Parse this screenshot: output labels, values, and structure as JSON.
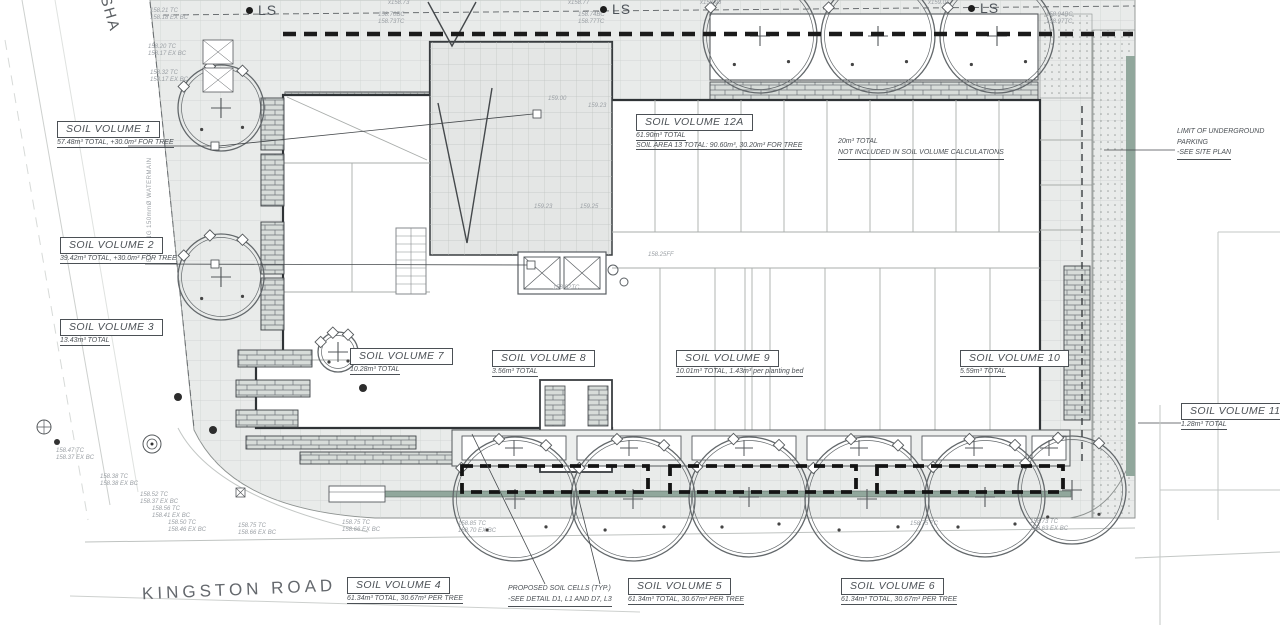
{
  "roads": {
    "kingston": "KINGSTON ROAD",
    "side_street": "SHA",
    "watermain": "EXISTING 150mmØ WATERMAIN"
  },
  "ls_label": "LS",
  "ls_markers": [
    {
      "x": 246,
      "y": 2
    },
    {
      "x": 600,
      "y": 1
    },
    {
      "x": 968,
      "y": 0
    }
  ],
  "soil_volumes": [
    {
      "id": "1",
      "x": 57,
      "y": 119,
      "title": "SOIL VOLUME 1",
      "sub": "57.48m³ TOTAL, +30.0m³ FOR TREE"
    },
    {
      "id": "2",
      "x": 60,
      "y": 235,
      "title": "SOIL VOLUME 2",
      "sub": "39.42m³ TOTAL, +30.0m³ FOR TREE"
    },
    {
      "id": "3",
      "x": 60,
      "y": 317,
      "title": "SOIL VOLUME 3",
      "sub": "13.43m³ TOTAL"
    },
    {
      "id": "12a",
      "x": 636,
      "y": 112,
      "title": "SOIL VOLUME 12A",
      "sub": "61.90m³ TOTAL",
      "sub2": "SOIL AREA 13 TOTAL: 90.60m³, 30.20m³ FOR TREE"
    },
    {
      "id": "7",
      "x": 350,
      "y": 346,
      "title": "SOIL VOLUME 7",
      "sub": "10.28m³ TOTAL"
    },
    {
      "id": "8",
      "x": 492,
      "y": 348,
      "title": "SOIL VOLUME 8",
      "sub": "3.56m³ TOTAL"
    },
    {
      "id": "9",
      "x": 676,
      "y": 348,
      "title": "SOIL VOLUME 9",
      "sub": "10.01m³ TOTAL, 1.43m³ per planting bed"
    },
    {
      "id": "10",
      "x": 960,
      "y": 348,
      "title": "SOIL VOLUME 10",
      "sub": "5.59m³ TOTAL"
    },
    {
      "id": "11",
      "x": 1181,
      "y": 401,
      "title": "SOIL VOLUME 11",
      "sub": "1.28m³ TOTAL"
    },
    {
      "id": "4",
      "x": 347,
      "y": 575,
      "title": "SOIL VOLUME 4",
      "sub": "61.34m³ TOTAL, 30.67m³ PER TREE"
    },
    {
      "id": "5",
      "x": 628,
      "y": 576,
      "title": "SOIL VOLUME 5",
      "sub": "61.34m³ TOTAL, 30.67m³ PER TREE"
    },
    {
      "id": "6",
      "x": 841,
      "y": 576,
      "title": "SOIL VOLUME 6",
      "sub": "61.34m³ TOTAL, 30.67m³ PER TREE"
    }
  ],
  "notes": [
    {
      "id": "underground-parking",
      "x": 1177,
      "y": 127,
      "lines": [
        {
          "t": "LIMIT OF UNDERGROUND"
        },
        {
          "t": "PARKING"
        },
        {
          "t": "-SEE SITE PLAN",
          "u": true
        }
      ]
    },
    {
      "id": "not-included",
      "x": 838,
      "y": 137,
      "lines": [
        {
          "t": "20m³ TOTAL"
        },
        {
          "t": "NOT INCLUDED IN SOIL VOLUME CALCULATIONS",
          "u": true
        }
      ]
    },
    {
      "id": "proposed-soil-cells",
      "x": 508,
      "y": 584,
      "lines": [
        {
          "t": "PROPOSED SOIL CELLS (TYP.)"
        },
        {
          "t": "-SEE DETAIL D1, L1 AND D7, L3",
          "u": true
        }
      ]
    }
  ],
  "spot_elevations": [
    {
      "x": 150,
      "y": 8,
      "l1": "158.21 TC",
      "l2": "158.18 EX BC"
    },
    {
      "x": 148,
      "y": 44,
      "l1": "158.20 TC",
      "l2": "158.17 EX BC"
    },
    {
      "x": 150,
      "y": 70,
      "l1": "158.32 TC",
      "l2": "158.17 EX BC"
    },
    {
      "x": 378,
      "y": 12,
      "l1": "158.70BC",
      "l2": "158.73TC"
    },
    {
      "x": 578,
      "y": 12,
      "l1": "158.74BC",
      "l2": "158.77TC"
    },
    {
      "x": 1046,
      "y": 12,
      "l1": "158.94BC",
      "l2": "158.97TC"
    },
    {
      "x": 388,
      "y": 0,
      "l1": "x158.73"
    },
    {
      "x": 568,
      "y": 0,
      "l1": "x158.77"
    },
    {
      "x": 700,
      "y": 0,
      "l1": "x158.96"
    },
    {
      "x": 928,
      "y": 0,
      "l1": "x159.01"
    },
    {
      "x": 56,
      "y": 448,
      "l1": "158.47 TC",
      "l2": "158.37 EX BC"
    },
    {
      "x": 100,
      "y": 474,
      "l1": "158.38 TC",
      "l2": "158.38 EX BC"
    },
    {
      "x": 140,
      "y": 492,
      "l1": "158.52 TC",
      "l2": "158.37 EX BC"
    },
    {
      "x": 152,
      "y": 506,
      "l1": "158.56 TC",
      "l2": "158.41 EX BC"
    },
    {
      "x": 168,
      "y": 520,
      "l1": "158.50 TC",
      "l2": "158.46 EX BC"
    },
    {
      "x": 238,
      "y": 523,
      "l1": "158.75 TC",
      "l2": "158.66 EX BC"
    },
    {
      "x": 342,
      "y": 520,
      "l1": "158.75 TC",
      "l2": "158.66 EX BC"
    },
    {
      "x": 458,
      "y": 521,
      "l1": "158.85 TC",
      "l2": "158.70 EX BC"
    },
    {
      "x": 910,
      "y": 521,
      "l1": "158.75 TC"
    },
    {
      "x": 1030,
      "y": 519,
      "l1": "158.73 TC",
      "l2": "158.63 EX BC"
    },
    {
      "x": 548,
      "y": 96,
      "l1": "159.00"
    },
    {
      "x": 588,
      "y": 103,
      "l1": "159.23"
    },
    {
      "x": 534,
      "y": 204,
      "l1": "159.23"
    },
    {
      "x": 580,
      "y": 204,
      "l1": "159.25"
    },
    {
      "x": 553,
      "y": 285,
      "l1": "158.92TC"
    },
    {
      "x": 648,
      "y": 252,
      "l1": "158.25FF"
    }
  ],
  "trees": [
    {
      "cx": 760,
      "cy": 36,
      "r": 57
    },
    {
      "cx": 878,
      "cy": 36,
      "r": 57
    },
    {
      "cx": 997,
      "cy": 36,
      "r": 57
    },
    {
      "cx": 221,
      "cy": 108,
      "r": 43
    },
    {
      "cx": 221,
      "cy": 277,
      "r": 43
    },
    {
      "cx": 338,
      "cy": 352,
      "r": 20
    },
    {
      "cx": 515,
      "cy": 499,
      "r": 62
    },
    {
      "cx": 633,
      "cy": 499,
      "r": 62
    },
    {
      "cx": 749,
      "cy": 497,
      "r": 60
    },
    {
      "cx": 867,
      "cy": 499,
      "r": 62
    },
    {
      "cx": 985,
      "cy": 497,
      "r": 60
    },
    {
      "cx": 1072,
      "cy": 490,
      "r": 54
    }
  ],
  "soil_cells": [
    {
      "x": 462,
      "y": 466,
      "w": 186,
      "h": 26
    },
    {
      "x": 670,
      "y": 466,
      "w": 186,
      "h": 26
    },
    {
      "x": 877,
      "y": 466,
      "w": 186,
      "h": 26
    }
  ],
  "planter_boxes": [
    {
      "x": 462,
      "y": 436,
      "w": 104,
      "h": 24
    },
    {
      "x": 577,
      "y": 436,
      "w": 104,
      "h": 24
    },
    {
      "x": 692,
      "y": 436,
      "w": 104,
      "h": 24
    },
    {
      "x": 807,
      "y": 436,
      "w": 104,
      "h": 24
    },
    {
      "x": 922,
      "y": 436,
      "w": 104,
      "h": 24
    },
    {
      "x": 1032,
      "y": 436,
      "w": 34,
      "h": 24
    }
  ],
  "colors": {
    "paper": "#ffffff",
    "sidewalk": "#e9ebea",
    "line_dark": "#2f3336",
    "line_light": "#c3c7c5",
    "text": "#6d7278",
    "green_strip": "#91a79c",
    "brick": "#d7dcd9"
  }
}
